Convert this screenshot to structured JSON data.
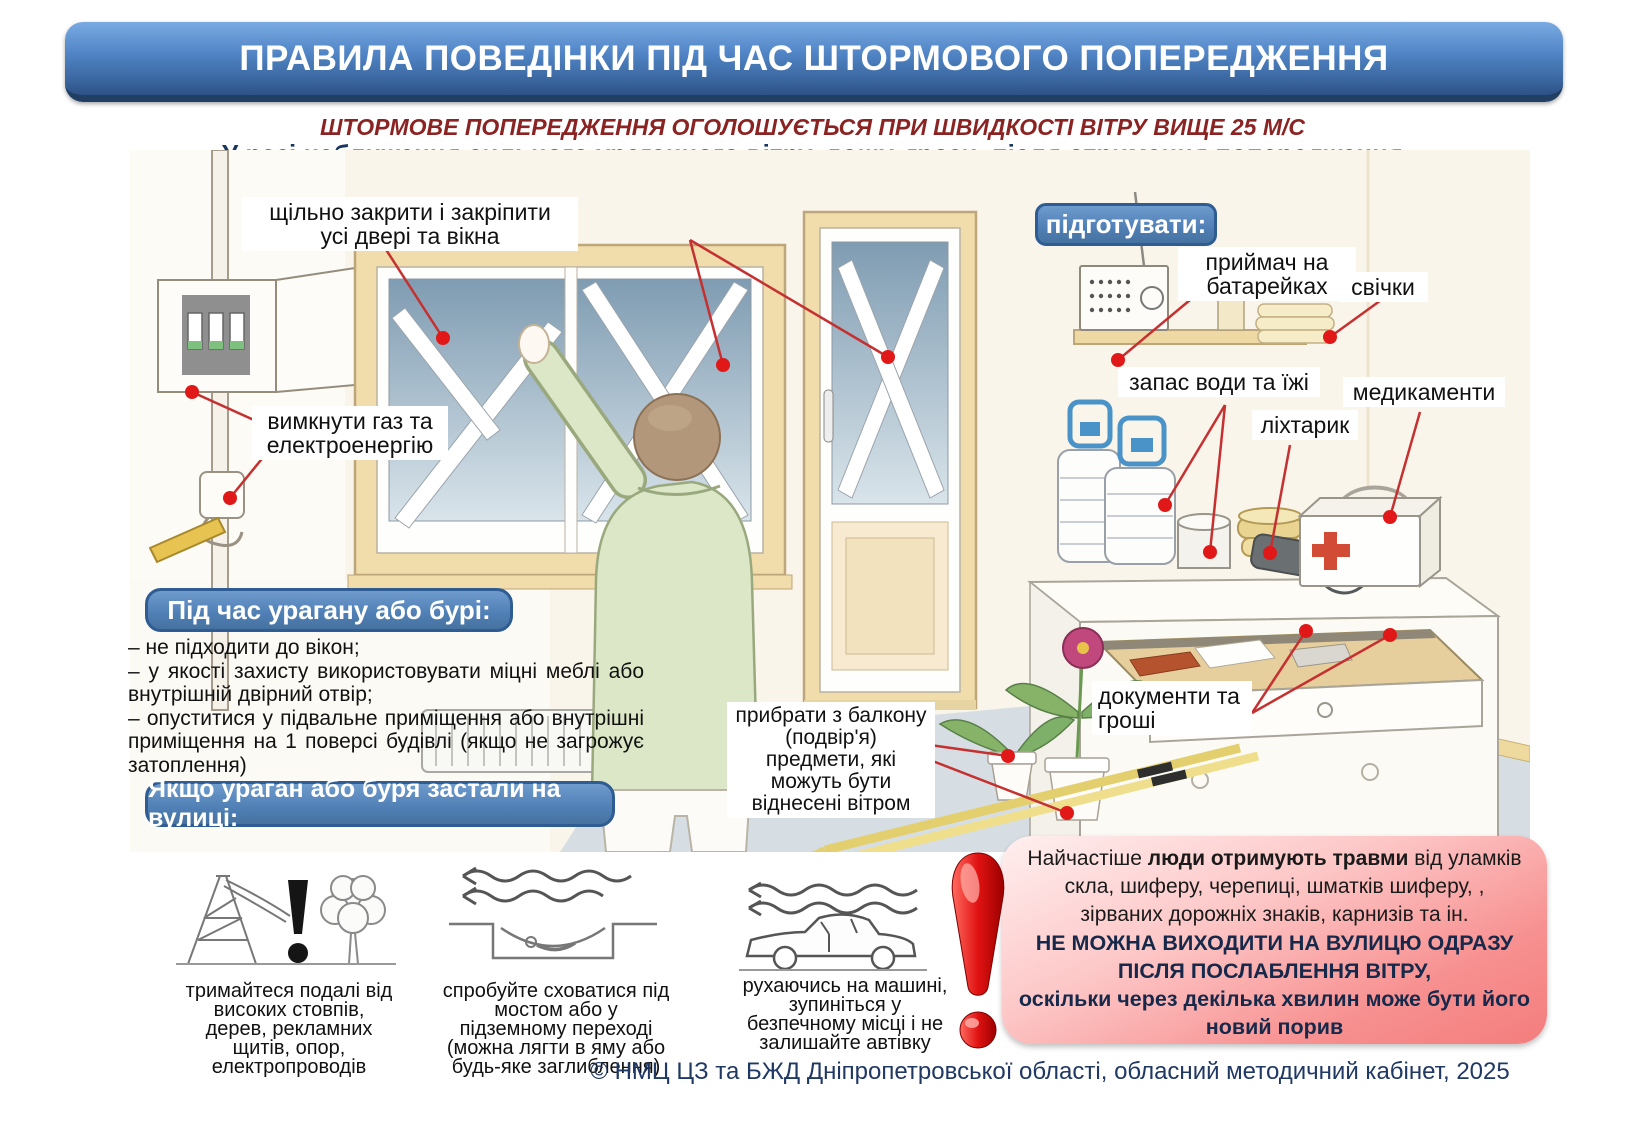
{
  "page": {
    "title": "ПРАВИЛА ПОВЕДІНКИ ПІД ЧАС ШТОРМОВОГО ПОПЕРЕДЖЕННЯ",
    "storm_condition": "ШТОРМОВЕ ПОПЕРЕДЖЕННЯ ОГОЛОШУЄТЬСЯ ПРИ ШВИДКОСТІ ВІТРУ ВИЩЕ 25 М/С",
    "intro": "У разі наближення сильного ураганного вітру, дощу, грози, після отримання попередження\n(по телефону, ТБ, радіо тощо) необхідно:",
    "footer": "© НМЦ ЦЗ та БЖД Дніпропетровської області, обласний методичний кабінет, 2025"
  },
  "labels": {
    "close_windows": "щільно  закрити і закріпити\nусі двері та вікна",
    "turn_off_gas": "вимкнути газ та\nелектроенергію",
    "prepare": "підготувати:",
    "radio": "приймач на\nбатарейках",
    "candles": "свічки",
    "water_food": "запас води та їжі",
    "medicines": "медикаменти",
    "flashlight": "ліхтарик",
    "documents": "документи та\nгроші",
    "balcony": "прибрати з балкону\n(подвір'я)\nпредмети, які\nможуть бути\nвіднесені вітром"
  },
  "during_storm": {
    "header": "Під час урагану або бурі:",
    "items": [
      "– не підходити до вікон;",
      "– у якості захисту використовувати міцні меблі або внутрішній двірний отвір;",
      "– опуститися у підвальне приміщення або внутрішні приміщення на 1 поверсі будівлі (якщо не загрожує затоплення)"
    ]
  },
  "outside": {
    "header": "Якщо ураган або буря застали на вулиці:",
    "tips": [
      {
        "icon": "power-line-and-tree",
        "caption": "тримайтеся подалі від\nвисоких стовпів,\nдерев, рекламних\nщитів, опор,\nелектропроводів"
      },
      {
        "icon": "underpass-shelter",
        "caption": "спробуйте сховатися під\nмостом або у\nпідземному переході\n(можна лягти в яму або\nбудь-яке заглиблення)"
      },
      {
        "icon": "car-in-wind",
        "caption": "рухаючись на машині,\nзупиніться у\nбезпечному місці і не\nзалишайте автівку"
      }
    ]
  },
  "warning": {
    "l1_pre": "Найчастіше ",
    "l1_bold": "люди отримують травми",
    "l1_post": " від уламків",
    "l2": "скла, шиферу, черепиці, шматків шиферу, ,",
    "l3": "зірваних дорожніх знаків, карнизів та ін.",
    "l4": "НЕ МОЖНА ВИХОДИТИ НА ВУЛИЦЮ ОДРАЗУ",
    "l5": "ПІСЛЯ ПОСЛАБЛЕННЯ ВІТРУ,",
    "l6": "оскільки через декілька хвилин може бути його",
    "l7": "новий порив"
  },
  "colors": {
    "banner_blue": "#4f83c4",
    "banner_shadow": "#203f63",
    "section_blue": "#4f7fb5",
    "section_border": "#2f5c92",
    "storm_red": "#8b2323",
    "navy_text": "#17375e",
    "pink_light": "#ffefef",
    "pink_deep": "#f47d7d",
    "leader_line_red": "#c53030",
    "exclamation_red": "#cc0f0f"
  }
}
